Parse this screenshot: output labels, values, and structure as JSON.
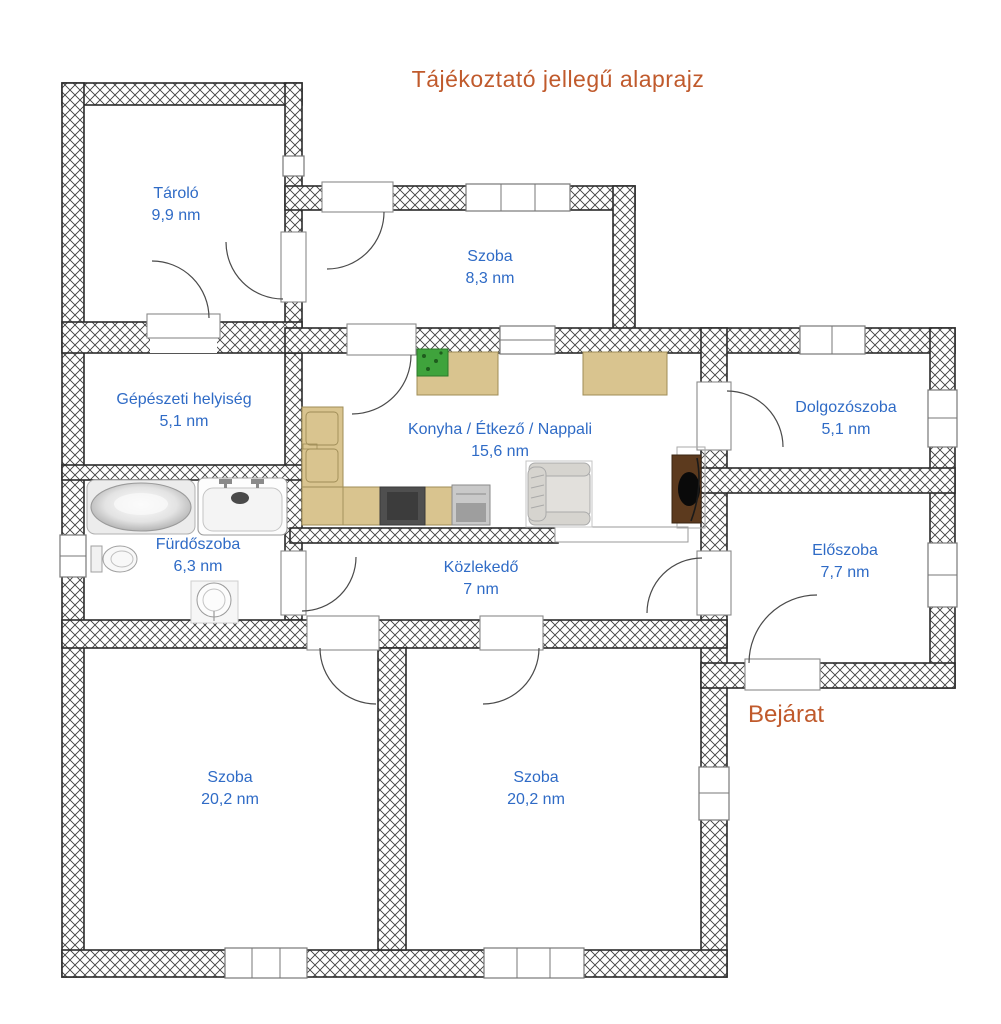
{
  "title": "Tájékoztató jellegű alaprajz",
  "entrance_label": "Bejárat",
  "rooms": [
    {
      "id": "tarolo",
      "name": "Tároló",
      "area": "9,9 nm"
    },
    {
      "id": "szoba-felso",
      "name": "Szoba",
      "area": "8,3 nm"
    },
    {
      "id": "gepeszeti",
      "name": "Gépészeti helyiség",
      "area": "5,1 nm"
    },
    {
      "id": "konyha",
      "name": "Konyha / Étkező / Nappali",
      "area": "15,6 nm"
    },
    {
      "id": "dolgozoszoba",
      "name": "Dolgozószoba",
      "area": "5,1 nm"
    },
    {
      "id": "eloszoba",
      "name": "Előszoba",
      "area": "7,7 nm"
    },
    {
      "id": "furdoszoba",
      "name": "Fürdőszoba",
      "area": "6,3 nm"
    },
    {
      "id": "kozlekedo",
      "name": "Közlekedő",
      "area": "7 nm"
    },
    {
      "id": "szoba-bal",
      "name": "Szoba",
      "area": "20,2 nm"
    },
    {
      "id": "szoba-jobb",
      "name": "Szoba",
      "area": "20,2 nm"
    }
  ],
  "colors": {
    "room-label": "#2f6bc6",
    "accent": "#c05a2c",
    "wall-line": "#2b2b2b",
    "hatch-line": "#3f3f3f",
    "counter-tan": "#d9c48f",
    "counter-tan-border": "#9f8d57",
    "stove-dark": "#4f4f4f",
    "appliance-gray": "#c9c9c9",
    "sofa-gray": "#d6d4cf",
    "tv-brown": "#5c3a1e",
    "plant-green": "#3fa33c",
    "fixture-line": "#9a9a9a",
    "door-line": "#4a4a4a",
    "frame-line": "#8a8a8a"
  }
}
